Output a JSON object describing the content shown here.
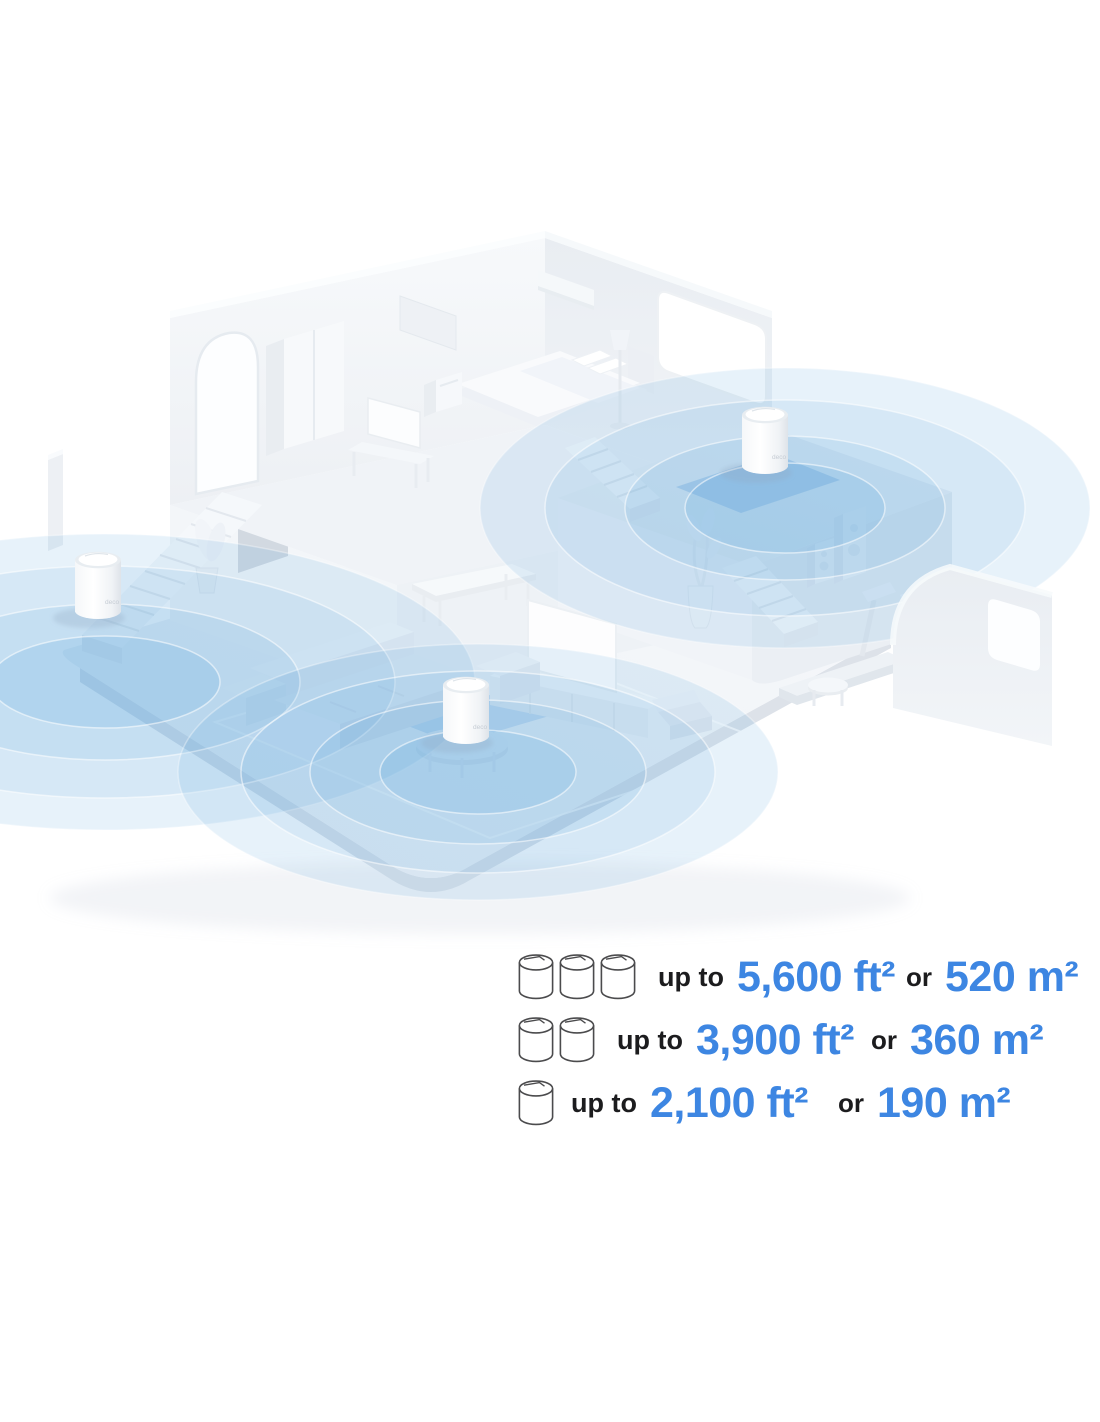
{
  "product": {
    "logo": "deco"
  },
  "colors": {
    "accent_blue_text": "#3D86E2",
    "coverage_blue": "#58A6DC",
    "background": "#ffffff"
  },
  "coverage_table": {
    "rows": [
      {
        "units": 3,
        "prefix": "up to",
        "area_ft": "5,600 ft²",
        "conjunction": "or",
        "area_m": "520 m²"
      },
      {
        "units": 2,
        "prefix": "up to",
        "area_ft": "3,900 ft²",
        "conjunction": "or",
        "area_m": "360 m²"
      },
      {
        "units": 1,
        "prefix": "up to",
        "area_ft": "2,100 ft²",
        "conjunction": "or",
        "area_m": "190 m²"
      }
    ]
  }
}
